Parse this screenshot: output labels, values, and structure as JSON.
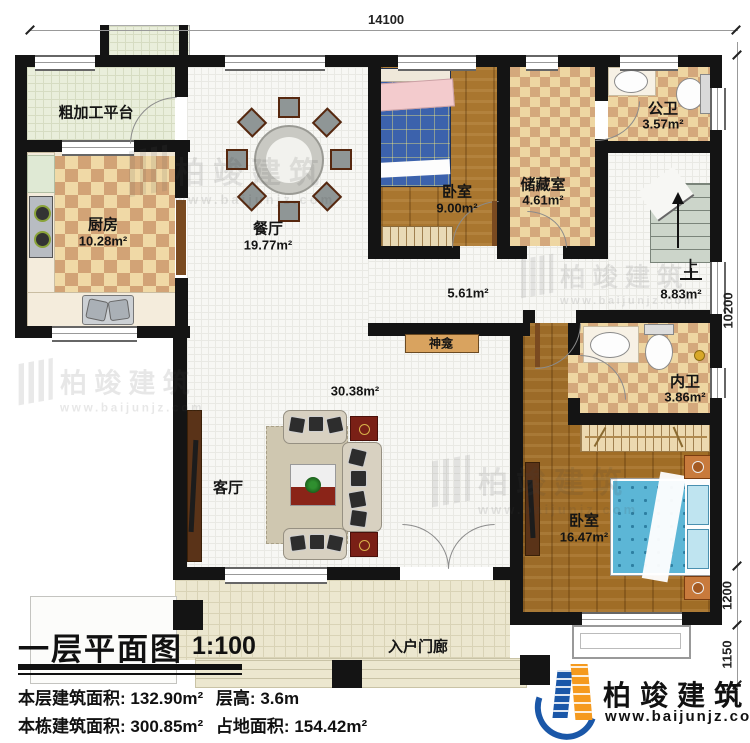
{
  "drawing": {
    "title": "一层平面图",
    "scale": "1:100",
    "stats": {
      "line1": [
        {
          "label": "本层建筑面积:",
          "value": "132.90m²"
        },
        {
          "label": "层高:",
          "value": "3.6m"
        }
      ],
      "line2": [
        {
          "label": "本栋建筑面积:",
          "value": "300.85m²"
        },
        {
          "label": "占地面积:",
          "value": "154.42m²"
        }
      ]
    }
  },
  "dims": {
    "top": "14100",
    "right": [
      "10200",
      "1200",
      "1150"
    ]
  },
  "rooms": {
    "platform": {
      "name": "粗加工平台"
    },
    "kitchen": {
      "name": "厨房",
      "area": "10.28m²"
    },
    "dining": {
      "name": "餐厅",
      "area": "19.77m²"
    },
    "bedroom1": {
      "name": "卧室",
      "area": "9.00m²"
    },
    "storage": {
      "name": "储藏室",
      "area": "4.61m²"
    },
    "public_bath": {
      "name": "公卫",
      "area": "3.57m²"
    },
    "hallway": {
      "area": "5.61m²"
    },
    "stair_hall": {
      "up": "上",
      "area": "8.83m²"
    },
    "shrine": {
      "name": "神龛"
    },
    "private_bath": {
      "name": "内卫",
      "area": "3.86m²"
    },
    "bedroom2": {
      "name": "卧室",
      "area": "16.47m²"
    },
    "living": {
      "name": "客厅",
      "area": "30.38m²"
    },
    "porch": {
      "name": "入户门廊"
    }
  },
  "logo": {
    "name": "柏竣建筑",
    "url": "www.baijunjz.com"
  },
  "watermark": {
    "text": "柏竣建筑",
    "url": "www.baijunjz.com"
  },
  "colors": {
    "wall": "#141414",
    "wood": "#a9762f",
    "tile_light": "#f0d9a6",
    "tile_dark": "#d2a376",
    "logo_blue": "#1a57a8",
    "logo_orange": "#f59a1e"
  }
}
